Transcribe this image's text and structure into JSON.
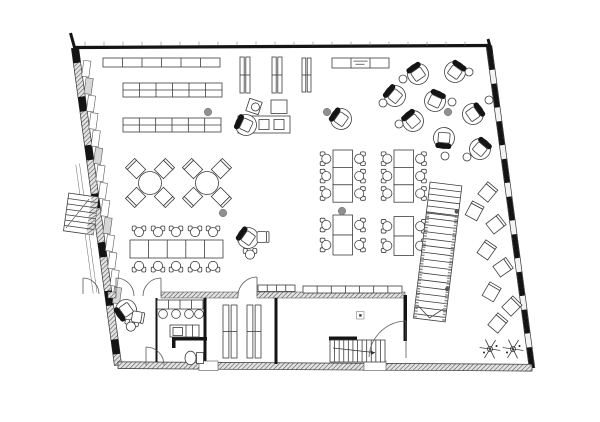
{
  "meta": {
    "figure_type": "architectural floor plan",
    "visible_text_legible": false
  },
  "colors": {
    "paper": "#ffffff",
    "ink": "#141414",
    "line": "#3d3d3d",
    "hatch_bg": "#e2e2e2",
    "hatch_line": "#4d4d4d",
    "gray_dot": "#8f8f8f",
    "panel_alt": "#d7d7d7",
    "label_line": "#8a8a8a"
  },
  "plan": {
    "walls": {
      "outline": {
        "tl": [
          75,
          48
        ],
        "tr": [
          489,
          46
        ],
        "br": [
          532,
          368
        ],
        "bl": [
          118,
          365
        ]
      },
      "apex_marks": [
        [
          70.5,
          33,
          75.5,
          51
        ],
        [
          488,
          39,
          491.5,
          52
        ]
      ],
      "top_ticks": {
        "x0": 85,
        "x1": 481,
        "step": 19,
        "y0": 41.6,
        "y1": 45.6
      },
      "interior_black": [
        [
          155.5,
          298,
          2,
          64
        ],
        [
          203.5,
          298,
          3,
          66
        ],
        [
          274.5,
          298,
          3,
          66
        ],
        [
          172,
          337,
          35,
          3.5
        ],
        [
          172,
          340,
          3.5,
          8
        ],
        [
          329,
          336.5,
          28,
          4
        ],
        [
          403.5,
          295,
          3.5,
          46
        ]
      ],
      "hatch_h": [
        [
          108,
          292,
          8,
          6
        ],
        [
          161,
          292,
          77,
          6
        ],
        [
          257,
          292,
          148,
          6
        ]
      ],
      "thresholds": [
        [
          199,
          361,
          19,
          9.5
        ],
        [
          364,
          361,
          22,
          9.5
        ]
      ],
      "walkway_lines": [
        [
          79.5,
          163.5,
          96.9,
          292.5
        ],
        [
          75.8,
          164.5,
          93.2,
          293.5
        ]
      ]
    },
    "doors": [
      {
        "leaf": [
          116,
          296,
          116,
          278
        ],
        "arc": "M116,278 A18,18 0 0 1 134,296"
      },
      {
        "leaf": [
          161,
          296,
          161,
          278
        ],
        "arc": "M161,278 A18,18 0 0 0 143,296"
      },
      {
        "leaf": [
          257,
          296,
          257,
          277
        ],
        "arc": "M257,277 A19,19 0 0 0 238,296"
      },
      {
        "leaf": [
          406,
          321,
          406,
          358
        ],
        "arc": "M406,321 A38,38 0 0 0 369,357"
      },
      {
        "leaf": [
          146,
          365,
          146,
          347
        ],
        "arc": "M146,347 A18,18 0 0 1 164,365"
      },
      {
        "leaf": [
          83,
          278,
          83,
          294
        ],
        "arc": "M83,278 A16,16 0 0 1 99,294"
      }
    ],
    "counters": [
      {
        "x": 103,
        "y": 58,
        "w": 117,
        "h": 9,
        "cols": 6,
        "rows": 1,
        "label": false
      },
      {
        "x": 123,
        "y": 83,
        "w": 99,
        "h": 14,
        "cols": 6,
        "rows": 2,
        "label": false
      },
      {
        "x": 123,
        "y": 118,
        "w": 98,
        "h": 14,
        "cols": 6,
        "rows": 2,
        "label": false
      },
      {
        "x": 332,
        "y": 58,
        "w": 57,
        "h": 10,
        "cols": 3,
        "rows": 1,
        "label": true
      },
      {
        "x": 258,
        "y": 285,
        "w": 37,
        "h": 6.5,
        "cols": 4,
        "rows": 1,
        "label": false
      },
      {
        "x": 303,
        "y": 286,
        "w": 99,
        "h": 7,
        "cols": 7,
        "rows": 1,
        "label": false
      }
    ],
    "label_box": {
      "legible": false
    },
    "shelves": [
      [
        240,
        57,
        10,
        36
      ],
      [
        272,
        57,
        10,
        36
      ],
      [
        302,
        58,
        9,
        34
      ],
      [
        223,
        305,
        14,
        53
      ],
      [
        247,
        305,
        14,
        53
      ]
    ],
    "round_tables": [
      [
        150,
        183
      ],
      [
        207,
        183
      ]
    ],
    "long_table": {
      "x": 130,
      "y": 240,
      "w": 93,
      "h": 18,
      "cols": 5,
      "chair_xs": [
        139,
        158,
        176,
        195,
        213
      ],
      "top_cy": 231.5,
      "bot_cy": 266.5
    },
    "table_groups": [
      {
        "x": 333,
        "y": 150,
        "tw": 19.5,
        "th": 17.4,
        "rows": 3
      },
      {
        "x": 394,
        "y": 150,
        "tw": 19.5,
        "th": 17.4,
        "rows": 3
      },
      {
        "x": 333,
        "y": 215,
        "tw": 19.5,
        "th": 20,
        "rows": 2
      },
      {
        "x": 394,
        "y": 216.5,
        "tw": 19.5,
        "th": 19.5,
        "rows": 2
      }
    ],
    "workstation": {
      "diamond_chair": [
        254,
        106.5,
        18
      ],
      "side_table": [
        271,
        100,
        16,
        13.5
      ],
      "counter": [
        238,
        116,
        52,
        17
      ],
      "inner_squares": [
        [
          259,
          119.5,
          10,
          10
        ],
        [
          274,
          119.5,
          10,
          10
        ]
      ]
    },
    "tub_chairs": [
      [
        418,
        74,
        -35
      ],
      [
        455,
        72,
        35
      ],
      [
        395,
        96,
        -50
      ],
      [
        435,
        101,
        25
      ],
      [
        341,
        119,
        -55
      ],
      [
        413,
        121,
        -40
      ],
      [
        473,
        114,
        55
      ],
      [
        444,
        138,
        185
      ],
      [
        480,
        149,
        40
      ],
      [
        248,
        238,
        -55
      ],
      [
        246,
        125,
        -65
      ],
      [
        126,
        310,
        -125
      ]
    ],
    "stools": [
      [
        403,
        79
      ],
      [
        469,
        72
      ],
      [
        383,
        103
      ],
      [
        489,
        100
      ],
      [
        452,
        102
      ],
      [
        399,
        124
      ],
      [
        445,
        156
      ],
      [
        467,
        157
      ]
    ],
    "arm_chairs": [
      [
        250,
        254,
        0
      ],
      [
        131,
        326,
        15
      ]
    ],
    "square_chairs": [
      [
        262,
        237,
        90
      ],
      [
        137,
        317,
        100
      ]
    ],
    "diamond_seats": [
      [
        487,
        193,
        40
      ],
      [
        474,
        212,
        28
      ],
      [
        495,
        225,
        52
      ],
      [
        486,
        251,
        35
      ],
      [
        502,
        268,
        55
      ],
      [
        491,
        293,
        30
      ],
      [
        511,
        307,
        45
      ],
      [
        497,
        324,
        40
      ]
    ],
    "gray_dots": [
      [
        208,
        112
      ],
      [
        223,
        213
      ],
      [
        342,
        211
      ],
      [
        327,
        112
      ],
      [
        448,
        112
      ]
    ],
    "plants": [
      [
        490,
        349
      ],
      [
        513,
        349
      ]
    ],
    "fixtures": {
      "sink_counter": {
        "x": 157,
        "y": 300,
        "w": 46,
        "h": 9,
        "cols": 4
      },
      "sinks": [
        [
          163,
          314
        ],
        [
          176,
          314
        ],
        [
          189,
          314
        ],
        [
          199,
          314
        ]
      ],
      "kitchenette": {
        "x": 170,
        "y": 325,
        "w": 29,
        "h": 12
      },
      "toilet": {
        "cx": 190.5,
        "cy": 358
      },
      "column_marker": [
        356.5,
        311.5
      ]
    },
    "stairs": {
      "main": {
        "x": 446,
        "y": 184,
        "rot": 7,
        "w": 32,
        "len": 137,
        "landing": 31,
        "upper_step": 6,
        "lower_start": 36,
        "lower_step": 6.9
      },
      "interior": {
        "x": 330,
        "y": 340,
        "w": 55,
        "h": 22,
        "treads": 11,
        "arrow": [
          333,
          348,
          375,
          352.6
        ]
      },
      "exterior": {
        "x": 81,
        "y": 214,
        "rot": 8,
        "w": 30,
        "h": 38,
        "treads": 7
      }
    }
  }
}
